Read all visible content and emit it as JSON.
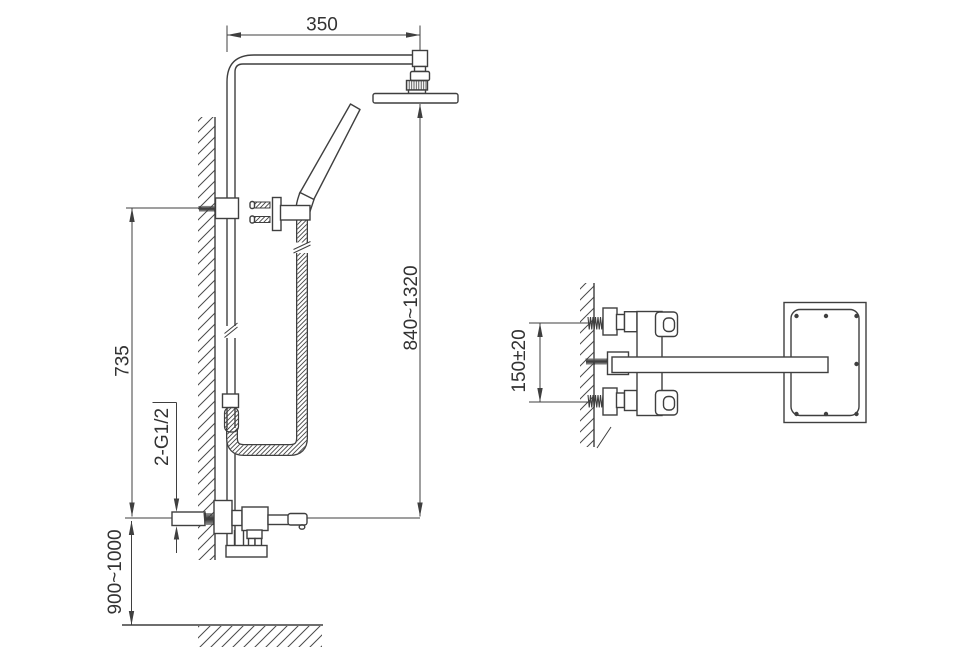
{
  "colors": {
    "line": "#3f3f3f",
    "text": "#333333",
    "background": "#ffffff"
  },
  "front_view": {
    "dim_top_width": "350",
    "dim_height_right": "840~1320",
    "dim_height_left": "735",
    "dim_floor_height": "900~1000",
    "inlet_thread_label": "2-G1/2"
  },
  "side_view": {
    "dim_inlet_spacing": "150±20"
  }
}
